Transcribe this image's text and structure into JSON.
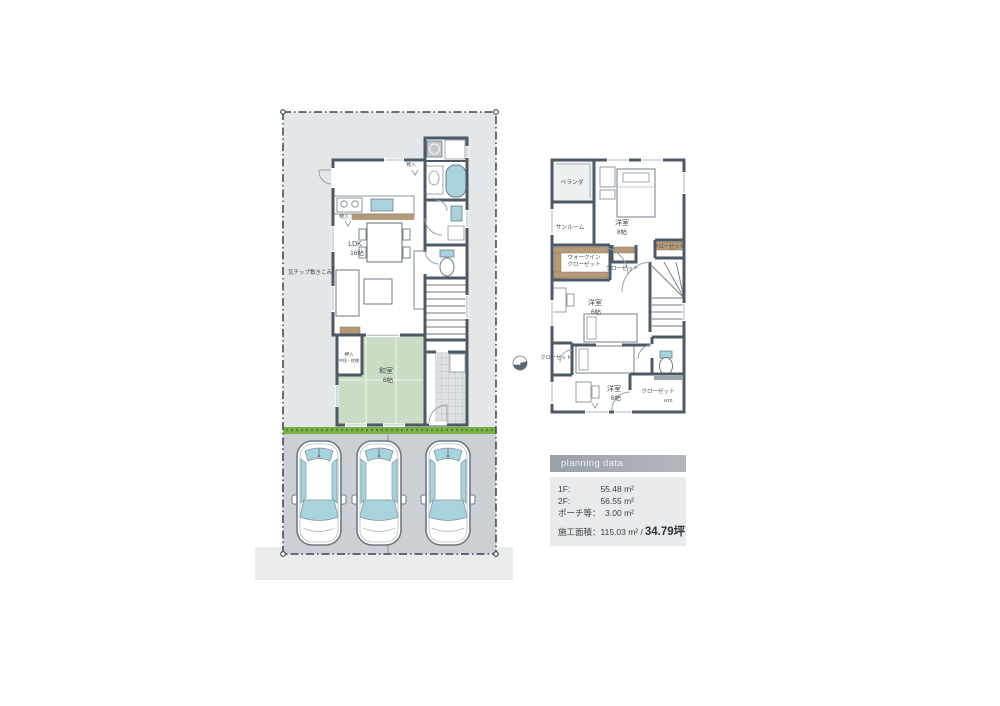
{
  "colors": {
    "wall": "#4d5965",
    "water_blue": "#a8d3dc",
    "tatami_green": "#cadcc4",
    "wood_tan": "#b49a77",
    "grass_green": "#79b147",
    "lot_gray": "#e4e7e9",
    "parking_gray": "#cccfd3",
    "road_gray": "#eaecec"
  },
  "site": {
    "note": "瓦チップ敷きこみ"
  },
  "floor1": {
    "ldk_name": "LDK",
    "ldk_size": "16帖",
    "washitsu_name": "和室",
    "washitsu_size": "6帖",
    "oshiire_name": "押入",
    "oshiire_note": "中段・枕棚",
    "storage_a": "物入",
    "storage_b": "物入"
  },
  "floor2": {
    "veranda": "ベランダ",
    "sunroom": "サンルーム",
    "room8_name": "洋室",
    "room8_size": "8帖",
    "wic_line1": "ウォークイン",
    "wic_line2": "クローゼット",
    "closet_mid": "クローゼット",
    "closet_right": "クローゼット",
    "closet_left": "クローゼット",
    "room6a_name": "洋室",
    "room6a_size": "6帖",
    "room6b_name": "洋室",
    "room6b_size": "6帖",
    "closet_bottom": "クローゼット",
    "closet_bottom_note": "H20"
  },
  "planning": {
    "header": "planning data",
    "rows": [
      {
        "label": "1F:",
        "value": "55.48 m²"
      },
      {
        "label": "2F:",
        "value": "56.55 m²"
      },
      {
        "label": "ポーチ等：",
        "value": "3.00 m²"
      }
    ],
    "total_label": "施工面積：115.03 m² /",
    "total_value": "34.79坪"
  }
}
